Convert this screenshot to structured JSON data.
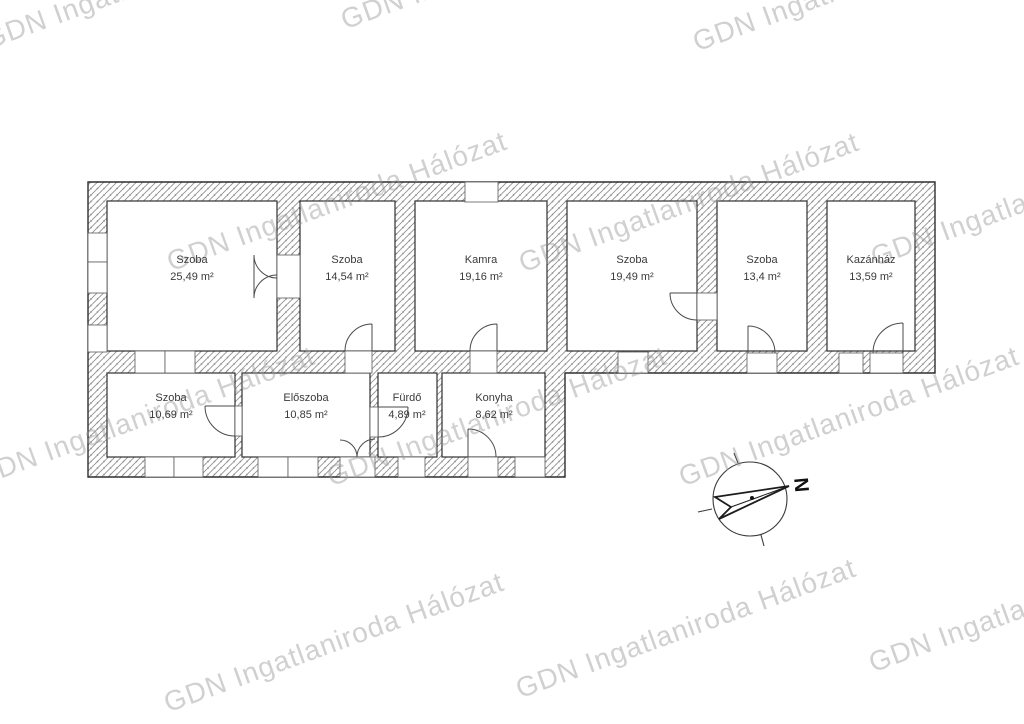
{
  "watermark": {
    "text": "GDN Ingatlaniroda Hálózat"
  },
  "compass": {
    "north_label": "N"
  },
  "rooms": [
    {
      "name": "Szoba",
      "area": "25,49 m²"
    },
    {
      "name": "Szoba",
      "area": "14,54 m²"
    },
    {
      "name": "Kamra",
      "area": "19,16 m²"
    },
    {
      "name": "Szoba",
      "area": "19,49 m²"
    },
    {
      "name": "Szoba",
      "area": "13,4 m²"
    },
    {
      "name": "Kazánház",
      "area": "13,59 m²"
    },
    {
      "name": "Szoba",
      "area": "10,69 m²"
    },
    {
      "name": "Előszoba",
      "area": "10,85 m²"
    },
    {
      "name": "Fürdő",
      "area": "4,89 m²"
    },
    {
      "name": "Konyha",
      "area": "8,62 m²"
    }
  ],
  "colors": {
    "wall_line": "#2e2e2e",
    "hatch_line": "#8d8d8d",
    "watermark": "#d5d5d5",
    "label_text": "#3a3a3a"
  }
}
